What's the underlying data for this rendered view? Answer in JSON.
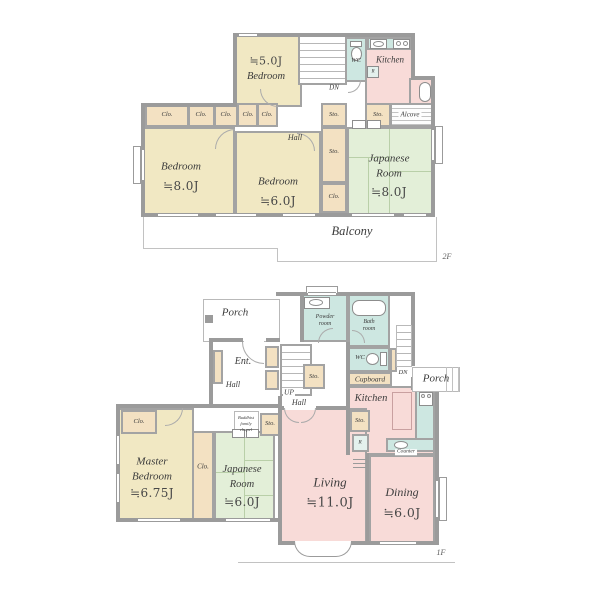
{
  "colors": {
    "wall": "#9b9b9b",
    "beige": "#f1e8c3",
    "tan": "#f3e1c2",
    "green": "#e3efd8",
    "pink": "#f8dbd8",
    "teal": "#cde7e1"
  },
  "f2": {
    "tag": "2F",
    "bedroom5_size": "≒5.0J",
    "bedroom5_name": "Bedroom",
    "bedroom8_name": "Bedroom",
    "bedroom8_size": "≒8.0J",
    "bedroom6_name": "Bedroom",
    "bedroom6_size": "≒6.0J",
    "jp_name1": "Japanese",
    "jp_name2": "Room",
    "jp_size": "≒8.0J",
    "kitchen": "Kitchen",
    "wc": "WC",
    "dn": "DN",
    "hall": "Hall",
    "alcove": "Alcove",
    "balcony": "Balcony",
    "sto": "Sto.",
    "clo": "Clo.",
    "r": "R"
  },
  "f1": {
    "tag": "1F",
    "porch": "Porch",
    "ent": "Ent.",
    "hall": "Hall",
    "up": "UP",
    "powder1": "Powder",
    "powder2": "room",
    "bath1": "Bath",
    "bath2": "room",
    "wc": "WC",
    "sto": "Sto.",
    "cupboard": "Cupboard",
    "dn": "DN",
    "kitchen": "Kitchen",
    "counter": "Counter",
    "r": "R",
    "clo": "Clo.",
    "chapel1": "Buddhist",
    "chapel2": "family",
    "chapel3": "chapel",
    "master1": "Master",
    "master2": "Bedroom",
    "master_size": "≒6.75J",
    "jp1": "Japanese",
    "jp2": "Room",
    "jp_size": "≒6.0J",
    "living": "Living",
    "living_size": "≒11.0J",
    "dining": "Dining",
    "dining_size": "≒6.0J"
  }
}
